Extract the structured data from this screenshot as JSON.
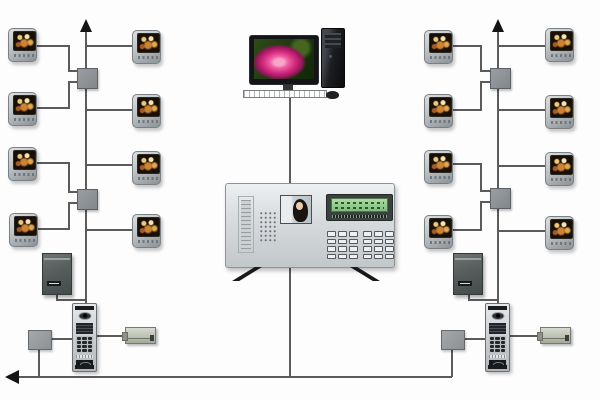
{
  "diagram_title": "Video door-phone intercom system wiring diagram",
  "colors": {
    "background": "#fdfdfd",
    "wire": "#5b5b5b",
    "arrow": "#141414",
    "monitor_body": "#b5babd",
    "monitor_screen": "#181007",
    "distributor_box": "#8f9397",
    "power_supply": "#575d5c",
    "door_station_panel": "#cfd2d5",
    "electric_lock": "#c0c4b6",
    "lcd_green": "#8cc88c",
    "pc_rose_pink": "#d42a7d",
    "management_panel": "#dadde0"
  },
  "devices": [
    {
      "id": "management-computer",
      "count": 1
    },
    {
      "id": "guard-management-center",
      "count": 1
    },
    {
      "id": "indoor-video-monitor",
      "count": 16
    },
    {
      "id": "floor-distributor-box",
      "count": 4
    },
    {
      "id": "entry-junction-box",
      "count": 2
    },
    {
      "id": "power-supply-unit",
      "count": 2
    },
    {
      "id": "outdoor-door-station",
      "count": 2
    },
    {
      "id": "electric-lock",
      "count": 2
    }
  ],
  "layout": {
    "monitors": [
      [
        8,
        28
      ],
      [
        132,
        30
      ],
      [
        8,
        92
      ],
      [
        132,
        94
      ],
      [
        8,
        147
      ],
      [
        132,
        151
      ],
      [
        9,
        213
      ],
      [
        132,
        214
      ],
      [
        424,
        30
      ],
      [
        545,
        28
      ],
      [
        424,
        94
      ],
      [
        545,
        95
      ],
      [
        424,
        150
      ],
      [
        545,
        152
      ],
      [
        424,
        215
      ],
      [
        545,
        216
      ]
    ],
    "distributors": [
      [
        77,
        68
      ],
      [
        77,
        189
      ],
      [
        490,
        68
      ],
      [
        490,
        188
      ]
    ],
    "entry_boxes": [
      [
        28,
        330
      ],
      [
        441,
        330
      ]
    ],
    "power_supplies": [
      [
        42,
        253
      ],
      [
        453,
        253
      ]
    ],
    "door_stations": [
      [
        72,
        303
      ],
      [
        485,
        303
      ]
    ],
    "locks": [
      [
        125,
        327
      ],
      [
        540,
        327
      ]
    ]
  },
  "wires": {
    "stroke_width": 2,
    "paths": [
      "86,29 86,303",
      "498,29 498,303",
      "290,98 290,184",
      "290,268 290,377",
      "10,377 452,377",
      "37,46 69,46 69,71 78,71",
      "78,82 69,82 69,108 37,108",
      "132,46 86,46",
      "132,110 86,110",
      "37,163 69,163 69,192 78,192",
      "78,203 69,203 69,229 38,229",
      "132,165 86,165",
      "132,230 86,230",
      "57,295 57,300 86,300",
      "39,348 39,377",
      "50,339 72,339",
      "97,336 125,336",
      "453,46 481,46 481,71 491,71",
      "491,82 481,82 481,110 453,110",
      "545,46 498,46",
      "545,110 498,110",
      "453,164 481,164 481,191 491,191",
      "491,202 481,202 481,230 453,230",
      "545,166 498,166",
      "545,231 498,231",
      "469,295 469,300 498,300",
      "452,348 452,377",
      "463,339 485,339",
      "510,336 540,336"
    ]
  },
  "arrows": {
    "up": [
      [
        86,
        19
      ],
      [
        498,
        19
      ]
    ],
    "left": [
      [
        5,
        377
      ]
    ]
  },
  "grids": {
    "door_keypad_cells": 12,
    "mgmt_keypad_group_cells": 12
  }
}
